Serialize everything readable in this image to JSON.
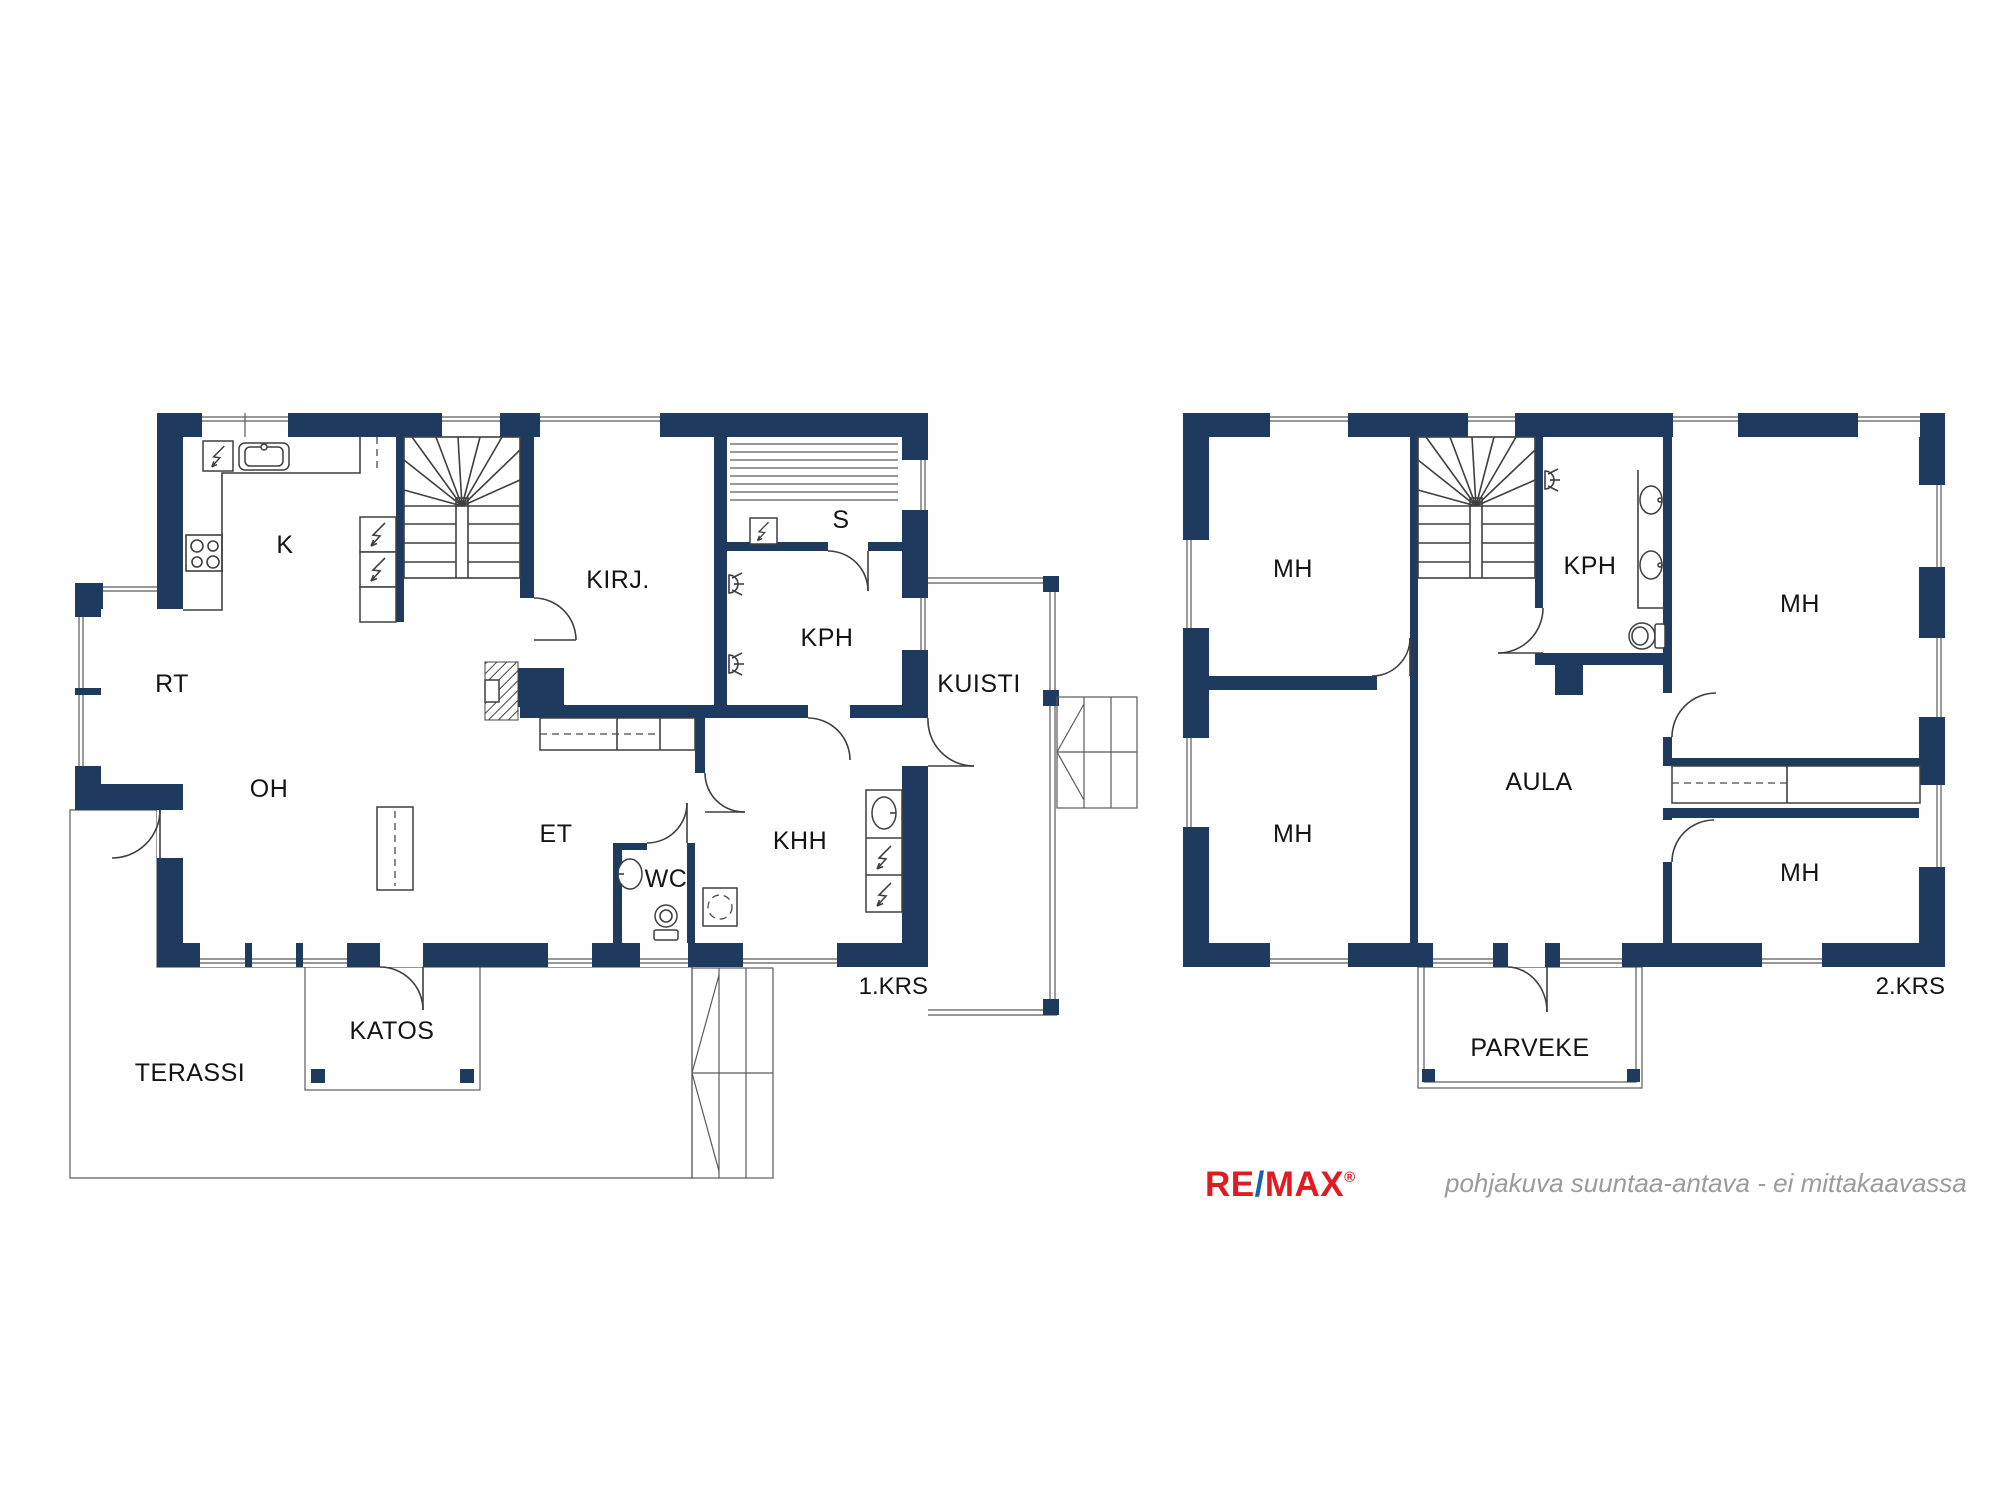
{
  "palette": {
    "wall_color": "#1f3a5f",
    "line_color": "#3f3f3f",
    "background": "#ffffff",
    "label_color": "#141414",
    "muted_text": "#9b9b9b",
    "remax_red": "#e11b22",
    "remax_blue": "#1761ad"
  },
  "floor1": {
    "floor_label": "1.KRS",
    "rooms": {
      "k": "K",
      "rt": "RT",
      "oh": "OH",
      "kirj": "KIRJ.",
      "s": "S",
      "kph": "KPH",
      "kuisti": "KUISTI",
      "et": "ET",
      "wc": "WC",
      "khh": "KHH",
      "katos": "KATOS",
      "terassi": "TERASSI"
    }
  },
  "floor2": {
    "floor_label": "2.KRS",
    "rooms": {
      "mh_top_left": "MH",
      "mh_bottom_left": "MH",
      "kph": "KPH",
      "mh_right_top": "MH",
      "aula": "AULA",
      "mh_right_bottom": "MH",
      "parveke": "PARVEKE"
    }
  },
  "footer": {
    "logo_re": "RE",
    "logo_slash": "/",
    "logo_max": "MAX",
    "logo_reg": "®",
    "disclaimer": "pohjakuva suuntaa-antava - ei mittakaavassa"
  }
}
